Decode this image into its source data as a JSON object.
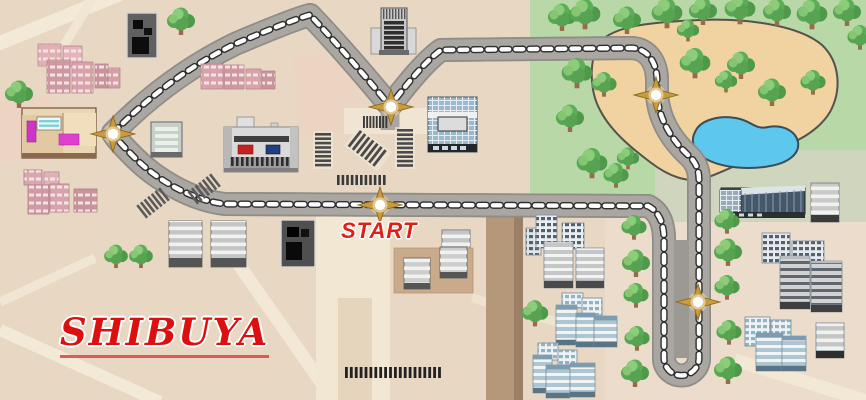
{
  "map": {
    "region_label": "SHIBUYA",
    "start_label": "START",
    "junction_marker_count": 5,
    "icons": {
      "junction": "compass-star-icon",
      "tree": "tree-icon",
      "crosswalk": "crosswalk-stripes-icon",
      "pond": "pond-shape",
      "course": "race-course-road"
    },
    "colors": {
      "ground_beige": "#e8d8c3",
      "street_light": "#f3e9d7",
      "park_green": "#b8d9a7",
      "sage_green": "#cfd6bd",
      "sand_tan": "#f0d3a0",
      "pond_blue": "#5ec7ee",
      "road_gray": "#a9a6a2",
      "dash_white": "#ffffff",
      "star_gold": "#c89b3c",
      "label_red": "#e01212",
      "building_pink": "#d8a2a8",
      "building_blue": "#aec6d4"
    }
  }
}
